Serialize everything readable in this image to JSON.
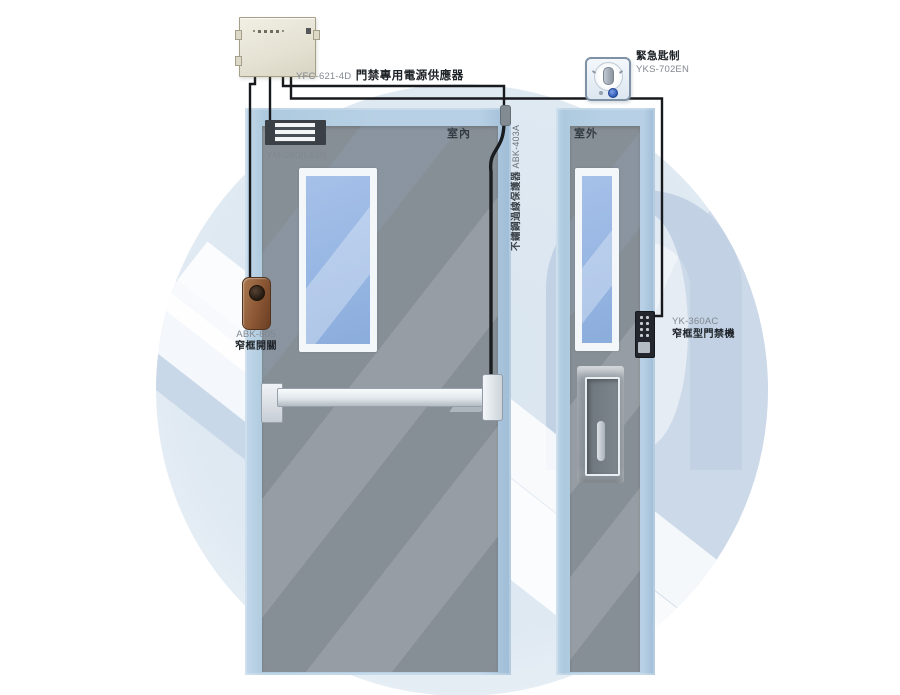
{
  "diagram": {
    "type": "access-control-installation-diagram",
    "views": {
      "inside": "室內",
      "outside": "室外"
    }
  },
  "components": {
    "power_supply": {
      "code": "YFC-621-4D",
      "name": "門禁專用電源供應器"
    },
    "maglock": {
      "code": "YM-280(LED)"
    },
    "cable_protector": {
      "name": "不鏽鋼過線保護器",
      "code": "ABK-403A"
    },
    "exit_button": {
      "code": "ABK-805",
      "name": "窄框開關"
    },
    "keypad": {
      "code": "YK-360AC",
      "name": "窄框型門禁機"
    },
    "emergency_switch": {
      "name": "緊急匙制",
      "code": "YKS-702EN"
    }
  },
  "colors": {
    "door_frame": "#b7d0e5",
    "door_panel": "#878f96",
    "watermark_circle": "#dfe9f2",
    "watermark_dark": "#c9d8e8",
    "wire": "#17191c",
    "glass": "#97b6e3",
    "emergency_button_blue": "#2a56b4"
  }
}
